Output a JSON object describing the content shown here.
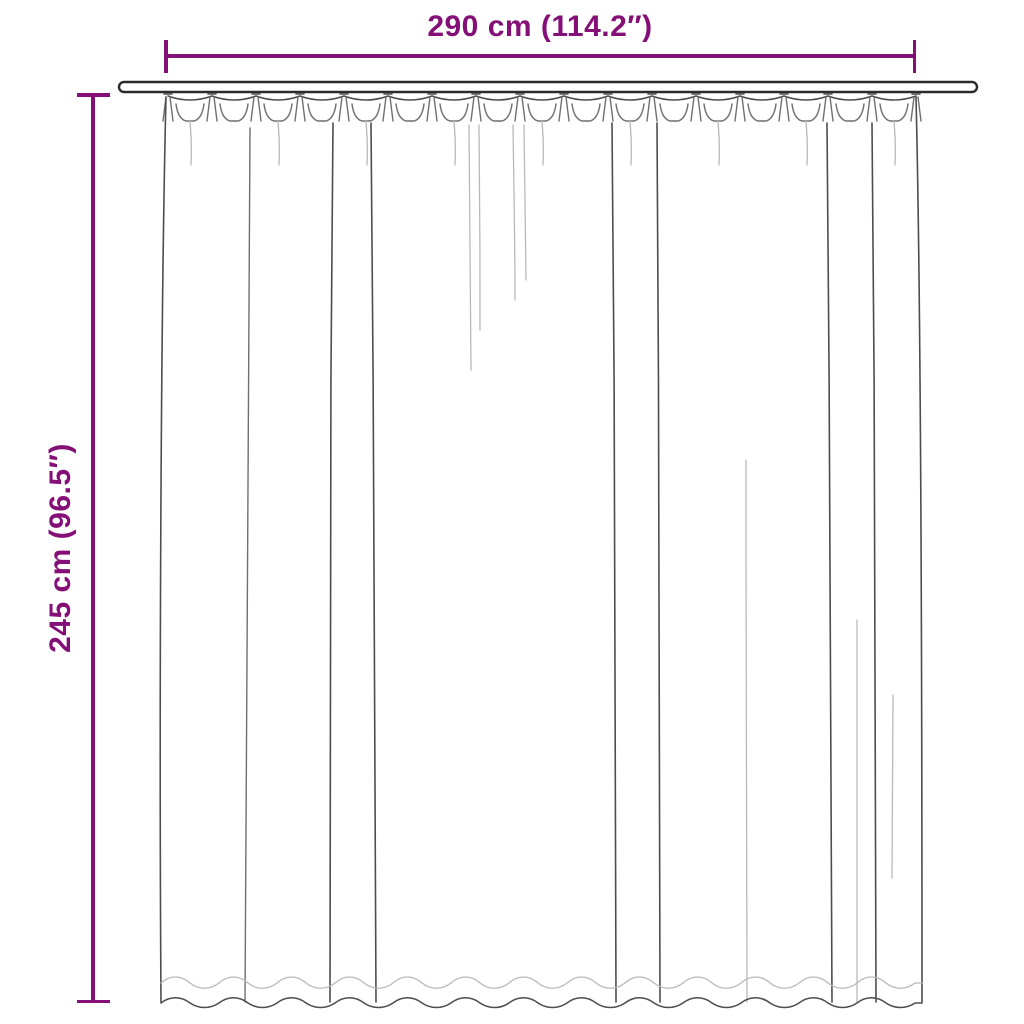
{
  "diagram": {
    "type": "product-dimension-diagram",
    "subject": "pleated curtain hanging on a rod (line drawing)",
    "background": "#ffffff"
  },
  "theme": {
    "accent": "#841077",
    "outline": "#2b2b2b",
    "fold_dark": "#4d4d4d",
    "fold_light": "#b9b9b9"
  },
  "dimensions": {
    "width": {
      "label": "290 cm (114.2″)",
      "cm": 290,
      "inches": 114.2
    },
    "height": {
      "label": "245 cm (96.5″)",
      "cm": 245,
      "inches": 96.5
    }
  }
}
